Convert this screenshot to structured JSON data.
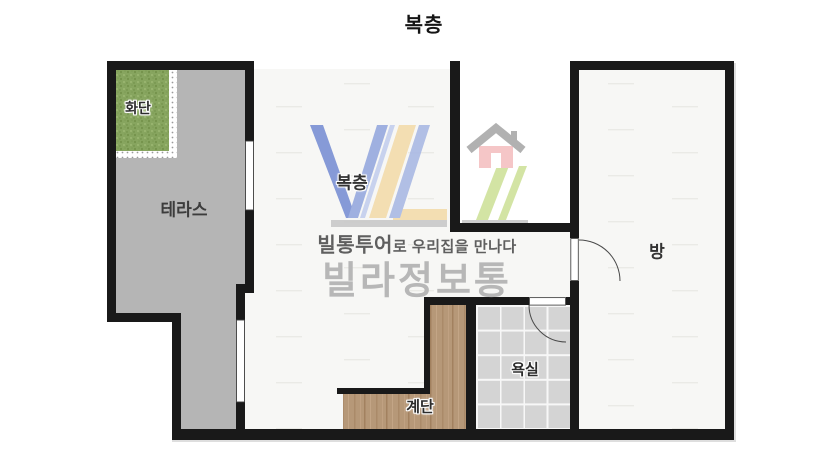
{
  "title": "복층",
  "labels": {
    "flower_bed": "화단",
    "terrace": "테라스",
    "loft": "복층",
    "room": "방",
    "bathroom": "욕실",
    "stairs": "계단"
  },
  "watermark": {
    "tagline_bold": "빌통투어",
    "tagline_rest": "로 우리집을 만나다",
    "brand": "빌라정보통",
    "house_icon": "house-icon"
  },
  "colors": {
    "wall": "#191919",
    "terrace_floor": "#b5b5b5",
    "room_floor": "#f7f7f5",
    "tile": "#d4d4d4",
    "wood": "#b69878",
    "grass": "#87a55f",
    "logo_blue": "#7a90d4",
    "logo_yellow": "#f3dcab",
    "logo_green": "#cfe29b",
    "house_pink": "#f5c0c2",
    "brand_gray": "#b7b7b7"
  }
}
